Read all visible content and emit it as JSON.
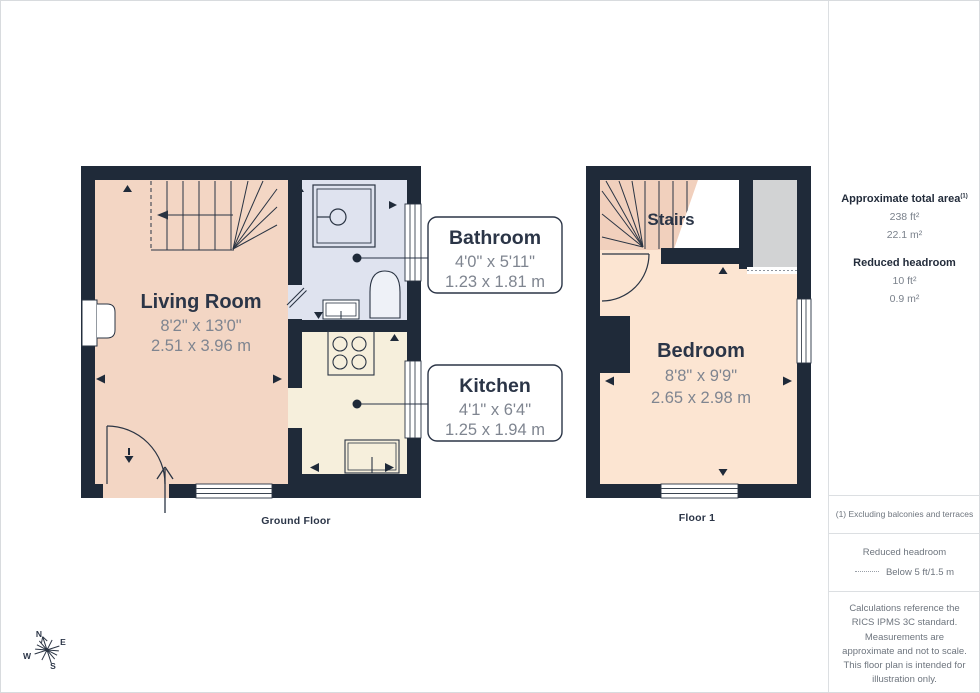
{
  "colors": {
    "wall": "#1f2a39",
    "living_room_fill": "#f3d6c4",
    "stairs_fill": "#f1d0bd",
    "bathroom_fill": "#dfe3ef",
    "kitchen_fill": "#f6efdc",
    "bedroom_fill": "#fce5d2",
    "reduced_headroom_fill": "#d2d3d4",
    "label_dark": "#2b3547",
    "label_gray": "#7f8590"
  },
  "ground_floor": {
    "label": "Ground Floor",
    "living_room": {
      "name": "Living Room",
      "dims_ft": "8'2\" x 13'0\"",
      "dims_m": "2.51 x 3.96 m"
    },
    "bathroom": {
      "name": "Bathroom",
      "dims_ft": "4'0\" x 5'11\"",
      "dims_m": "1.23 x 1.81 m"
    },
    "kitchen": {
      "name": "Kitchen",
      "dims_ft": "4'1\" x 6'4\"",
      "dims_m": "1.25 x 1.94 m"
    }
  },
  "floor_1": {
    "label": "Floor 1",
    "stairs_label": "Stairs",
    "bedroom": {
      "name": "Bedroom",
      "dims_ft": "8'8\" x 9'9\"",
      "dims_m": "2.65 x 2.98 m"
    }
  },
  "sidebar": {
    "total_area_heading": "Approximate total area",
    "total_area_footnote_marker": "(1)",
    "total_area_ft": "238 ft²",
    "total_area_m": "22.1 m²",
    "reduced_headroom_heading": "Reduced headroom",
    "reduced_headroom_ft": "10 ft²",
    "reduced_headroom_m": "0.9 m²",
    "footnote": "(1) Excluding balconies and terraces",
    "legend_heading": "Reduced headroom",
    "legend_value": "Below 5 ft/1.5 m",
    "disclaimer": "Calculations reference the RICS IPMS 3C standard. Measurements are approximate and not to scale. This floor plan is intended for illustration only.",
    "brand_name": "GIRAFFE",
    "brand_suffix": "360"
  },
  "compass": {
    "n": "N",
    "e": "E",
    "s": "S",
    "w": "W"
  }
}
